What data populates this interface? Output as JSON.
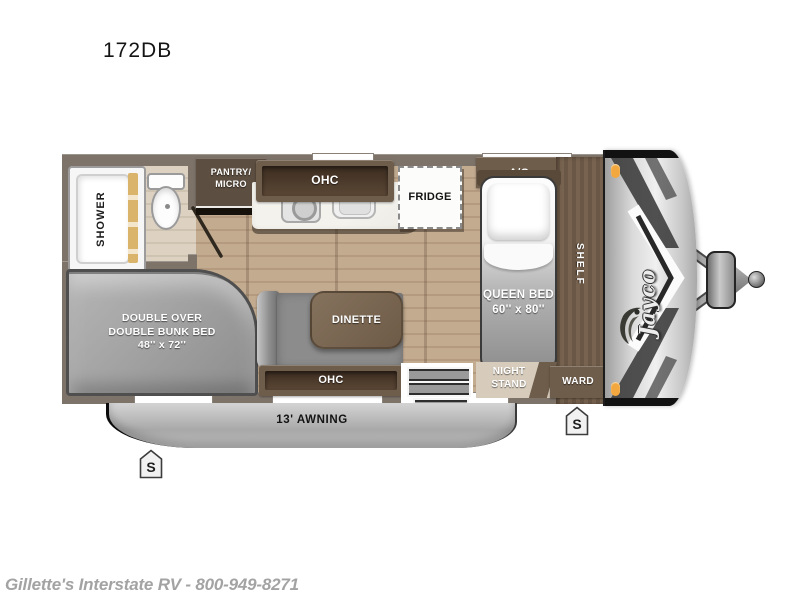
{
  "page": {
    "title": "172DB",
    "footer": "Gillette's Interstate RV - 800-949-8271"
  },
  "floorplan": {
    "brand_logo": "Jayco",
    "labels": {
      "shower": "SHOWER",
      "pantry_micro": "PANTRY/\nMICRO",
      "kitchen_ohc": "OHC",
      "fridge": "FRIDGE",
      "ac": "A/C",
      "queen_bed": "QUEEN BED\n60'' x 80''",
      "shelf": "SHELF",
      "night_stand": "NIGHT\nSTAND",
      "ward": "WARD",
      "bunk_bed": "DOUBLE OVER\nDOUBLE BUNK BED\n48'' x 72''",
      "dinette": "DINETTE",
      "dinette_ohc": "OHC",
      "awning": "13' AWNING",
      "stabilizer": "S"
    },
    "colors": {
      "wood_floor": "#bda68b",
      "bath_floor": "#d8cdbd",
      "wall": "#7d7369",
      "cabinet": "#6f5d4b",
      "cabinet_dark": "#4a392b",
      "mattress_gray": "#9b9b9b",
      "marker_light": "#f2a83e"
    }
  }
}
